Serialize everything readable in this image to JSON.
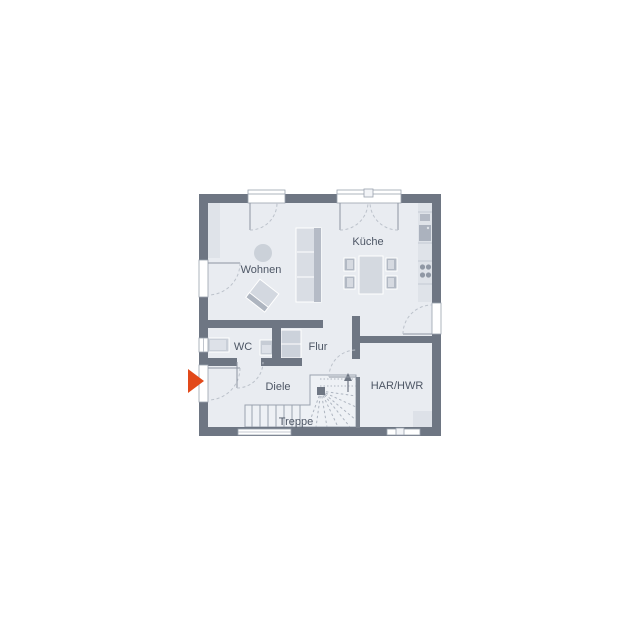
{
  "plan": {
    "type": "floor-plan",
    "rooms": [
      {
        "id": "wohnen",
        "label": "Wohnen"
      },
      {
        "id": "kueche",
        "label": "Küche"
      },
      {
        "id": "wc",
        "label": "WC"
      },
      {
        "id": "flur",
        "label": "Flur"
      },
      {
        "id": "diele",
        "label": "Diele"
      },
      {
        "id": "har-hwr",
        "label": "HAR/HWR"
      },
      {
        "id": "treppe",
        "label": "Treppe"
      }
    ],
    "entrance_marker": {
      "icon": "arrow-right",
      "color": "#e2491a"
    },
    "stairs": {
      "direction": "up",
      "shape": "L-winder"
    }
  },
  "palette": {
    "wall": "#6e7683",
    "floor": "#e9ecf1",
    "furniture_light": "#d9dde4",
    "furniture_mid": "#c3c9d2",
    "furniture_dark": "#b2b9c4",
    "counter": "#dfe3e9",
    "stair_fill": "#eef1f5",
    "line": "#9aa2ae",
    "dash": "#bcc2cb",
    "text": "#4d5665",
    "accent_orange": "#e2491a",
    "white": "#ffffff"
  }
}
